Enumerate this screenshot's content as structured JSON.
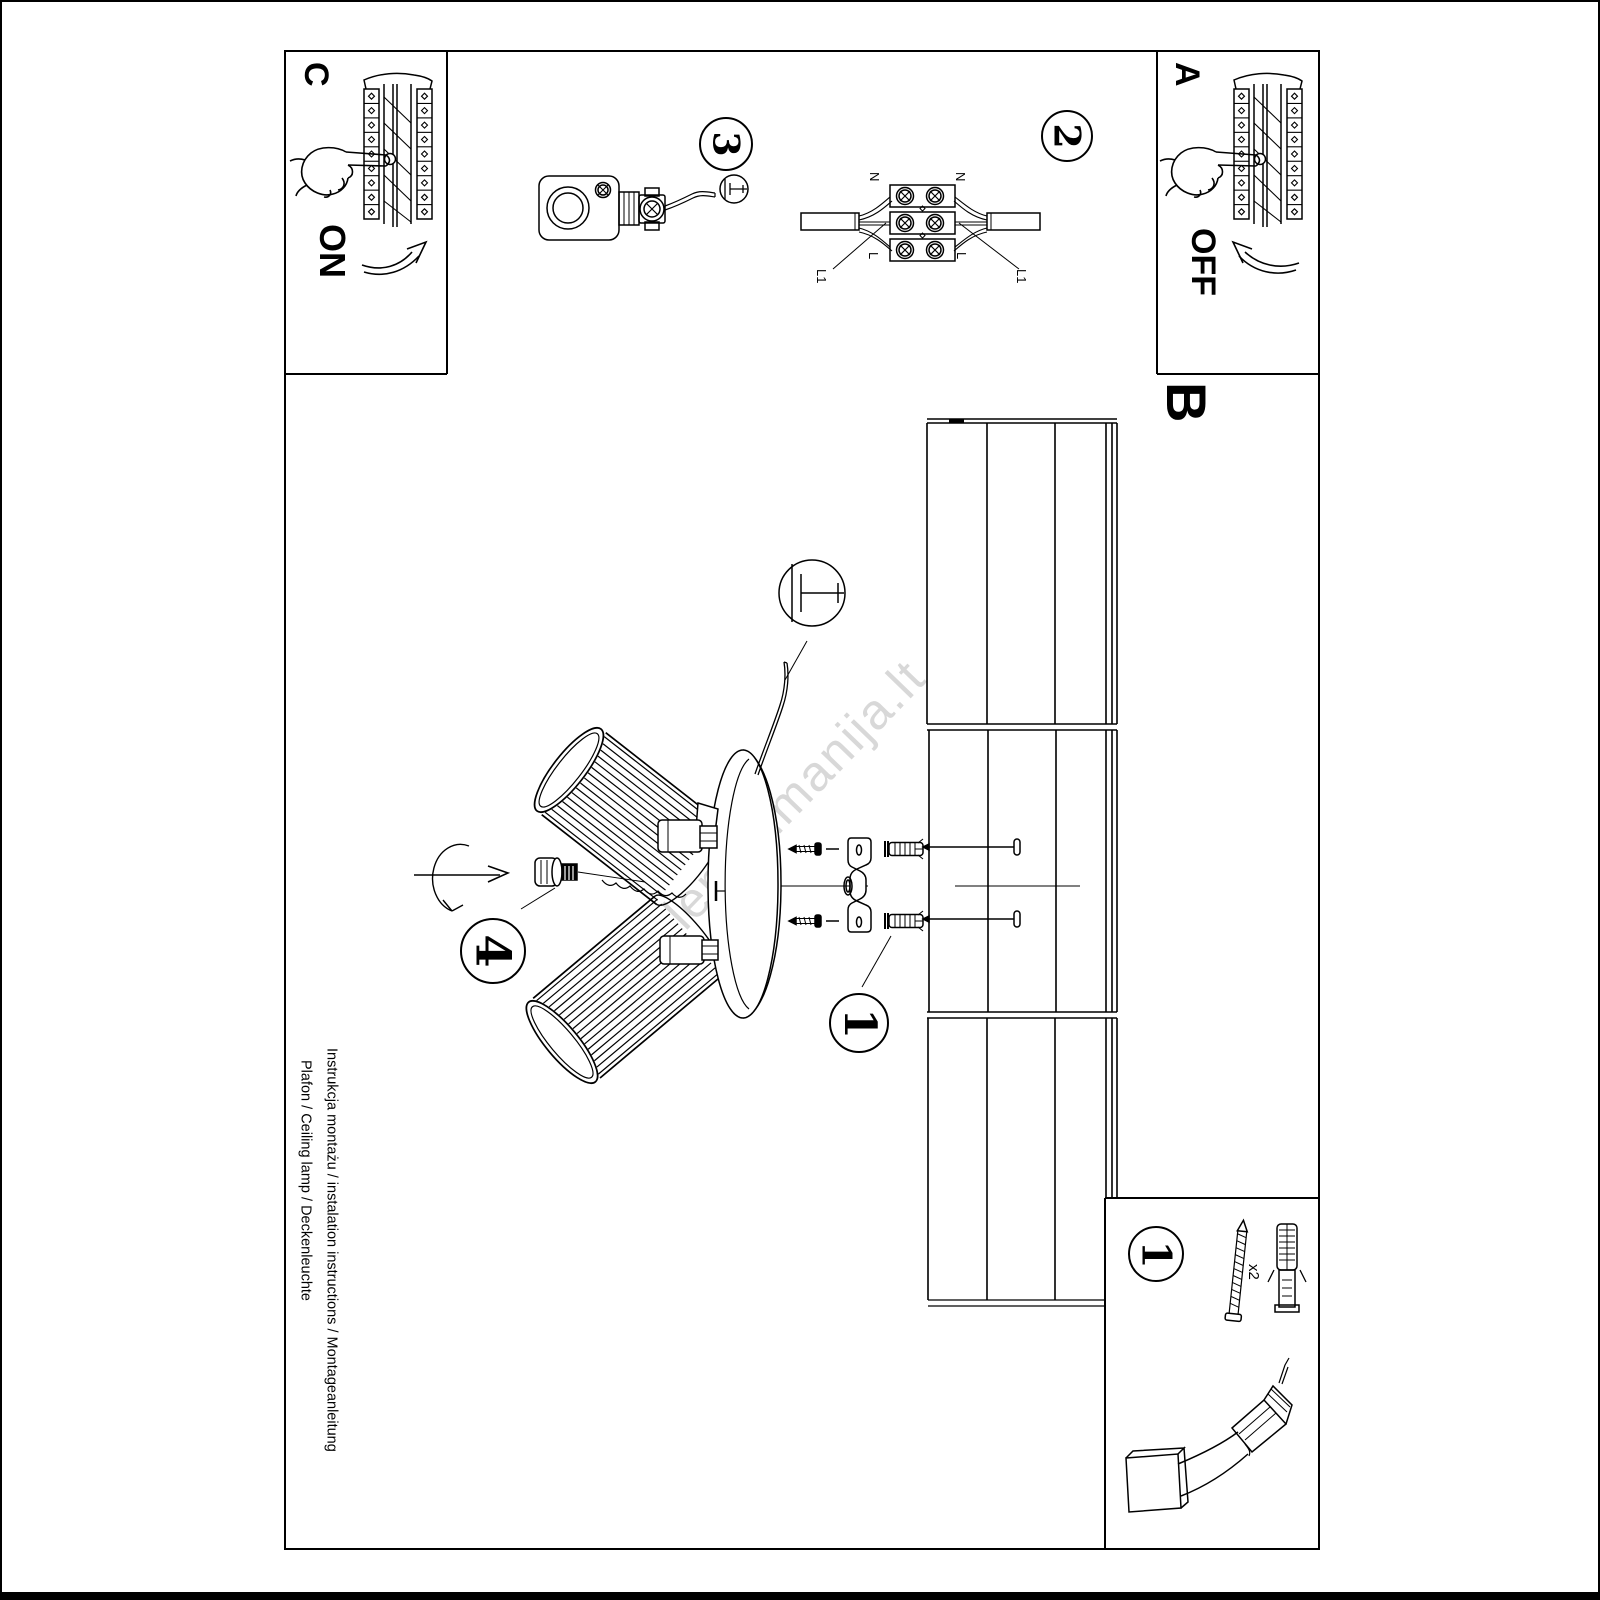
{
  "panel_c": {
    "label": "C",
    "action": "ON"
  },
  "panel_a": {
    "label": "A",
    "action": "OFF"
  },
  "section_b_label": "B",
  "steps": {
    "one": "1",
    "two": "2",
    "three": "3",
    "four": "4"
  },
  "wiring": {
    "n_left": "N",
    "n_right": "N",
    "l_left": "L",
    "l_right": "L",
    "l1_left": "L1",
    "l1_right": "L1"
  },
  "tools": {
    "badge": "1",
    "screw_qty": "x2"
  },
  "footer": {
    "line1": "Instrukcja montażu / instalation instructions / Montageanleitung",
    "line2": "Plafon / Ceiling lamp / Deckenleuchte"
  },
  "watermark": "lempumanija.lt",
  "colors": {
    "ink": "#000000",
    "paper": "#ffffff",
    "watermark": "#d8d8d8"
  }
}
